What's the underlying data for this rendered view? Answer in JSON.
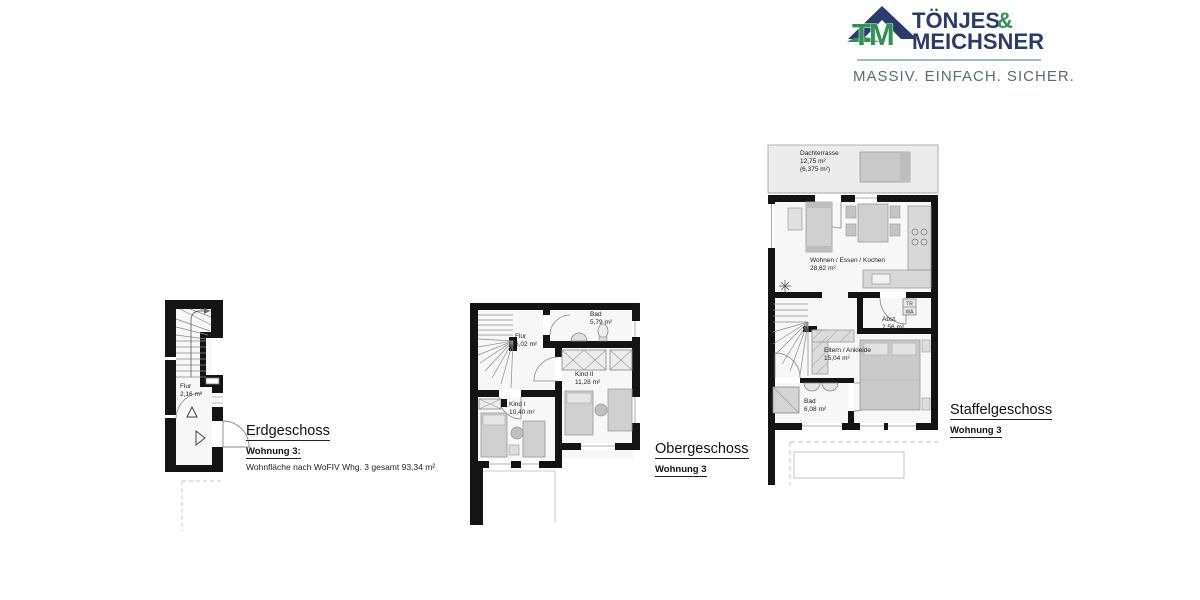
{
  "logo": {
    "mark": "TM",
    "brand_top": "TÖNJES",
    "brand_amp": "&",
    "brand_bottom": "MEICHSNER",
    "tagline": "MASSIV. EINFACH. SICHER.",
    "colors": {
      "navy": "#2a3b6e",
      "green": "#2f9152",
      "tagline_gray": "#5b6b79",
      "rule": "#86a0b4"
    }
  },
  "floors": {
    "erdgeschoss": {
      "title": "Erdgeschoss",
      "apartment": "Wohnung 3:",
      "note": "Wohnfläche nach WoFIV Whg. 3 gesamt 93,34 m²",
      "rooms": {
        "flur": {
          "name": "Flur",
          "area": "2,16 m²"
        }
      }
    },
    "obergeschoss": {
      "title": "Obergeschoss",
      "apartment": "Wohnung 3",
      "rooms": {
        "flur": {
          "name": "Flur",
          "area": "5,02 m²"
        },
        "bad": {
          "name": "Bad",
          "area": "5,79 m²"
        },
        "kind2": {
          "name": "Kind II",
          "area": "11,28 m²"
        },
        "kind1": {
          "name": "Kind I",
          "area": "10,40 m²"
        }
      }
    },
    "staffelgeschoss": {
      "title": "Staffelgeschoss",
      "apartment": "Wohnung 3",
      "rooms": {
        "dachterrasse": {
          "name": "Dachterrasse",
          "area": "12,75 m²",
          "area_note": "(6,375 m²)"
        },
        "wohnen": {
          "name": "Wohnen / Essen / Kochen",
          "area": "28,62 m²"
        },
        "abstell": {
          "name": "Abst.",
          "area": "2,56 m²"
        },
        "eltern": {
          "name": "Eltern / Ankleide",
          "area": "15,04 m²"
        },
        "bad": {
          "name": "Bad",
          "area": "6,08 m²"
        }
      },
      "appliances": {
        "dryer": "TR",
        "washer": "WA"
      }
    }
  }
}
